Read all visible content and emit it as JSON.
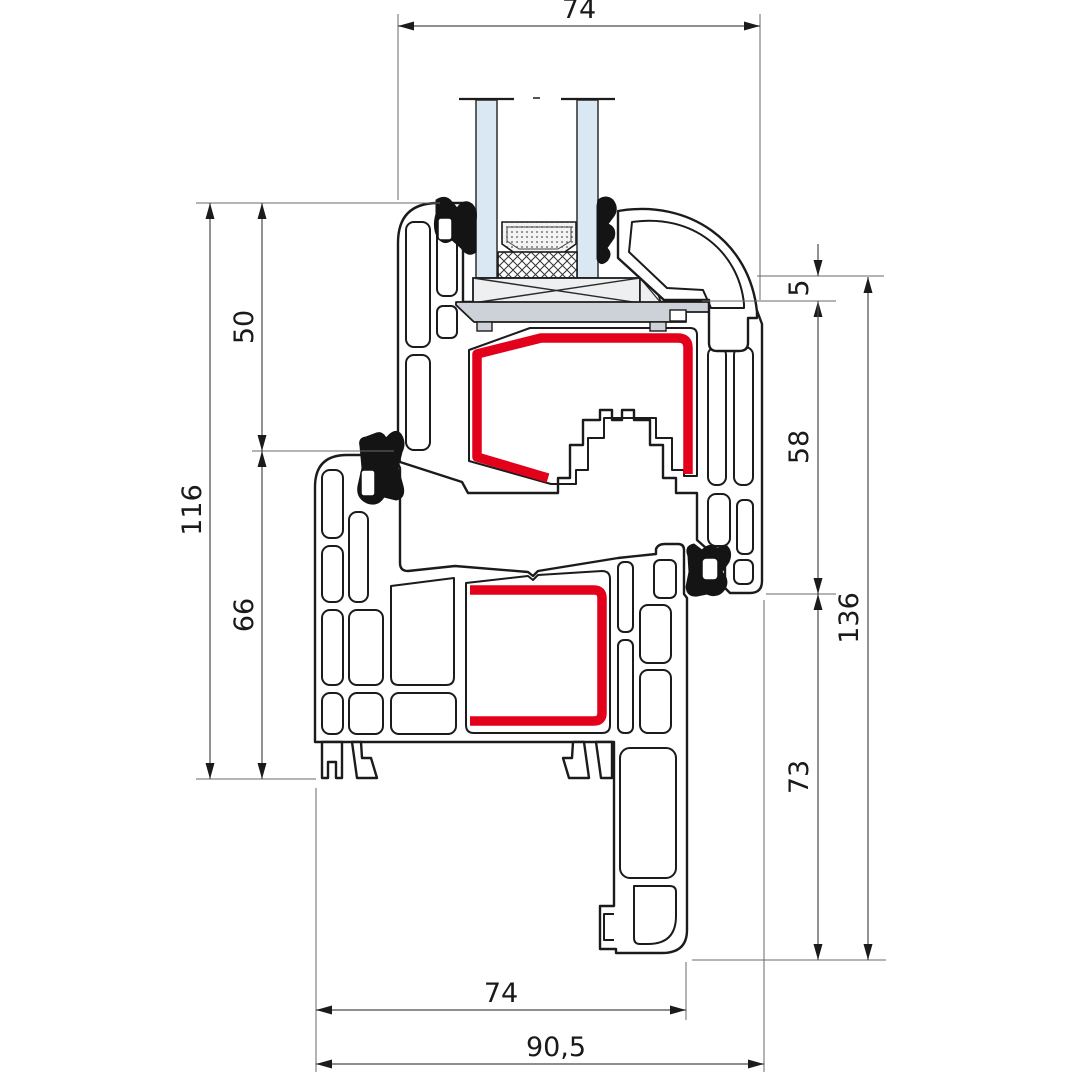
{
  "drawing": {
    "kind": "window-profile-cross-section",
    "dimensions": {
      "top_width": "74",
      "left_sash_height": "50",
      "left_total_height": "116",
      "left_frame_height": "66",
      "right_offset": "5",
      "right_sash_face": "58",
      "right_total": "136",
      "right_lower": "73",
      "bottom_frame_width": "74",
      "bottom_total_width": "90,5"
    },
    "colors": {
      "outline": "#1b1b1b",
      "steel_reinforcement_red": "#e2001a",
      "glass_blue": "#d9e8f3",
      "support_gray": "#ccd2d7",
      "block_gray": "#edeff1",
      "gasket_black": "#141414",
      "dimension_line_gray": "#4a4a4a"
    }
  }
}
